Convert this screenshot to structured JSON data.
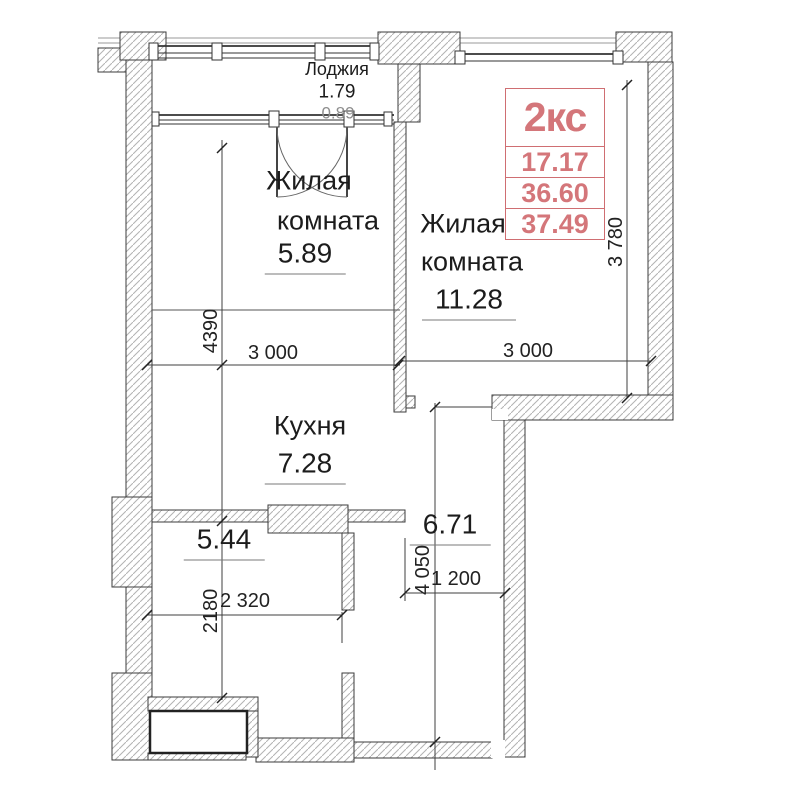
{
  "stamp": {
    "type": "2кс",
    "values": [
      "17.17",
      "36.60",
      "37.49"
    ],
    "color": "#d4767a"
  },
  "rooms": {
    "loggia": {
      "name": "Лоджия",
      "area": "1.79",
      "area_secondary": "0.89"
    },
    "living_room_1": {
      "name_line1": "Жилая",
      "name_line2": "комната",
      "area": "5.89"
    },
    "living_room_2": {
      "name_line1": "Жилая",
      "name_line2": "комната",
      "area": "11.28"
    },
    "kitchen": {
      "name": "Кухня",
      "area": "7.28"
    },
    "hallway": {
      "area": "5.44"
    },
    "corridor": {
      "area": "6.71"
    }
  },
  "dimensions": {
    "v_4390": "4390",
    "h_3000_left": "3 000",
    "h_3000_right": "3 000",
    "v_3780": "3 780",
    "v_2180": "2180",
    "h_2320": "2 320",
    "v_4050": "4 050",
    "h_1200": "1 200"
  }
}
